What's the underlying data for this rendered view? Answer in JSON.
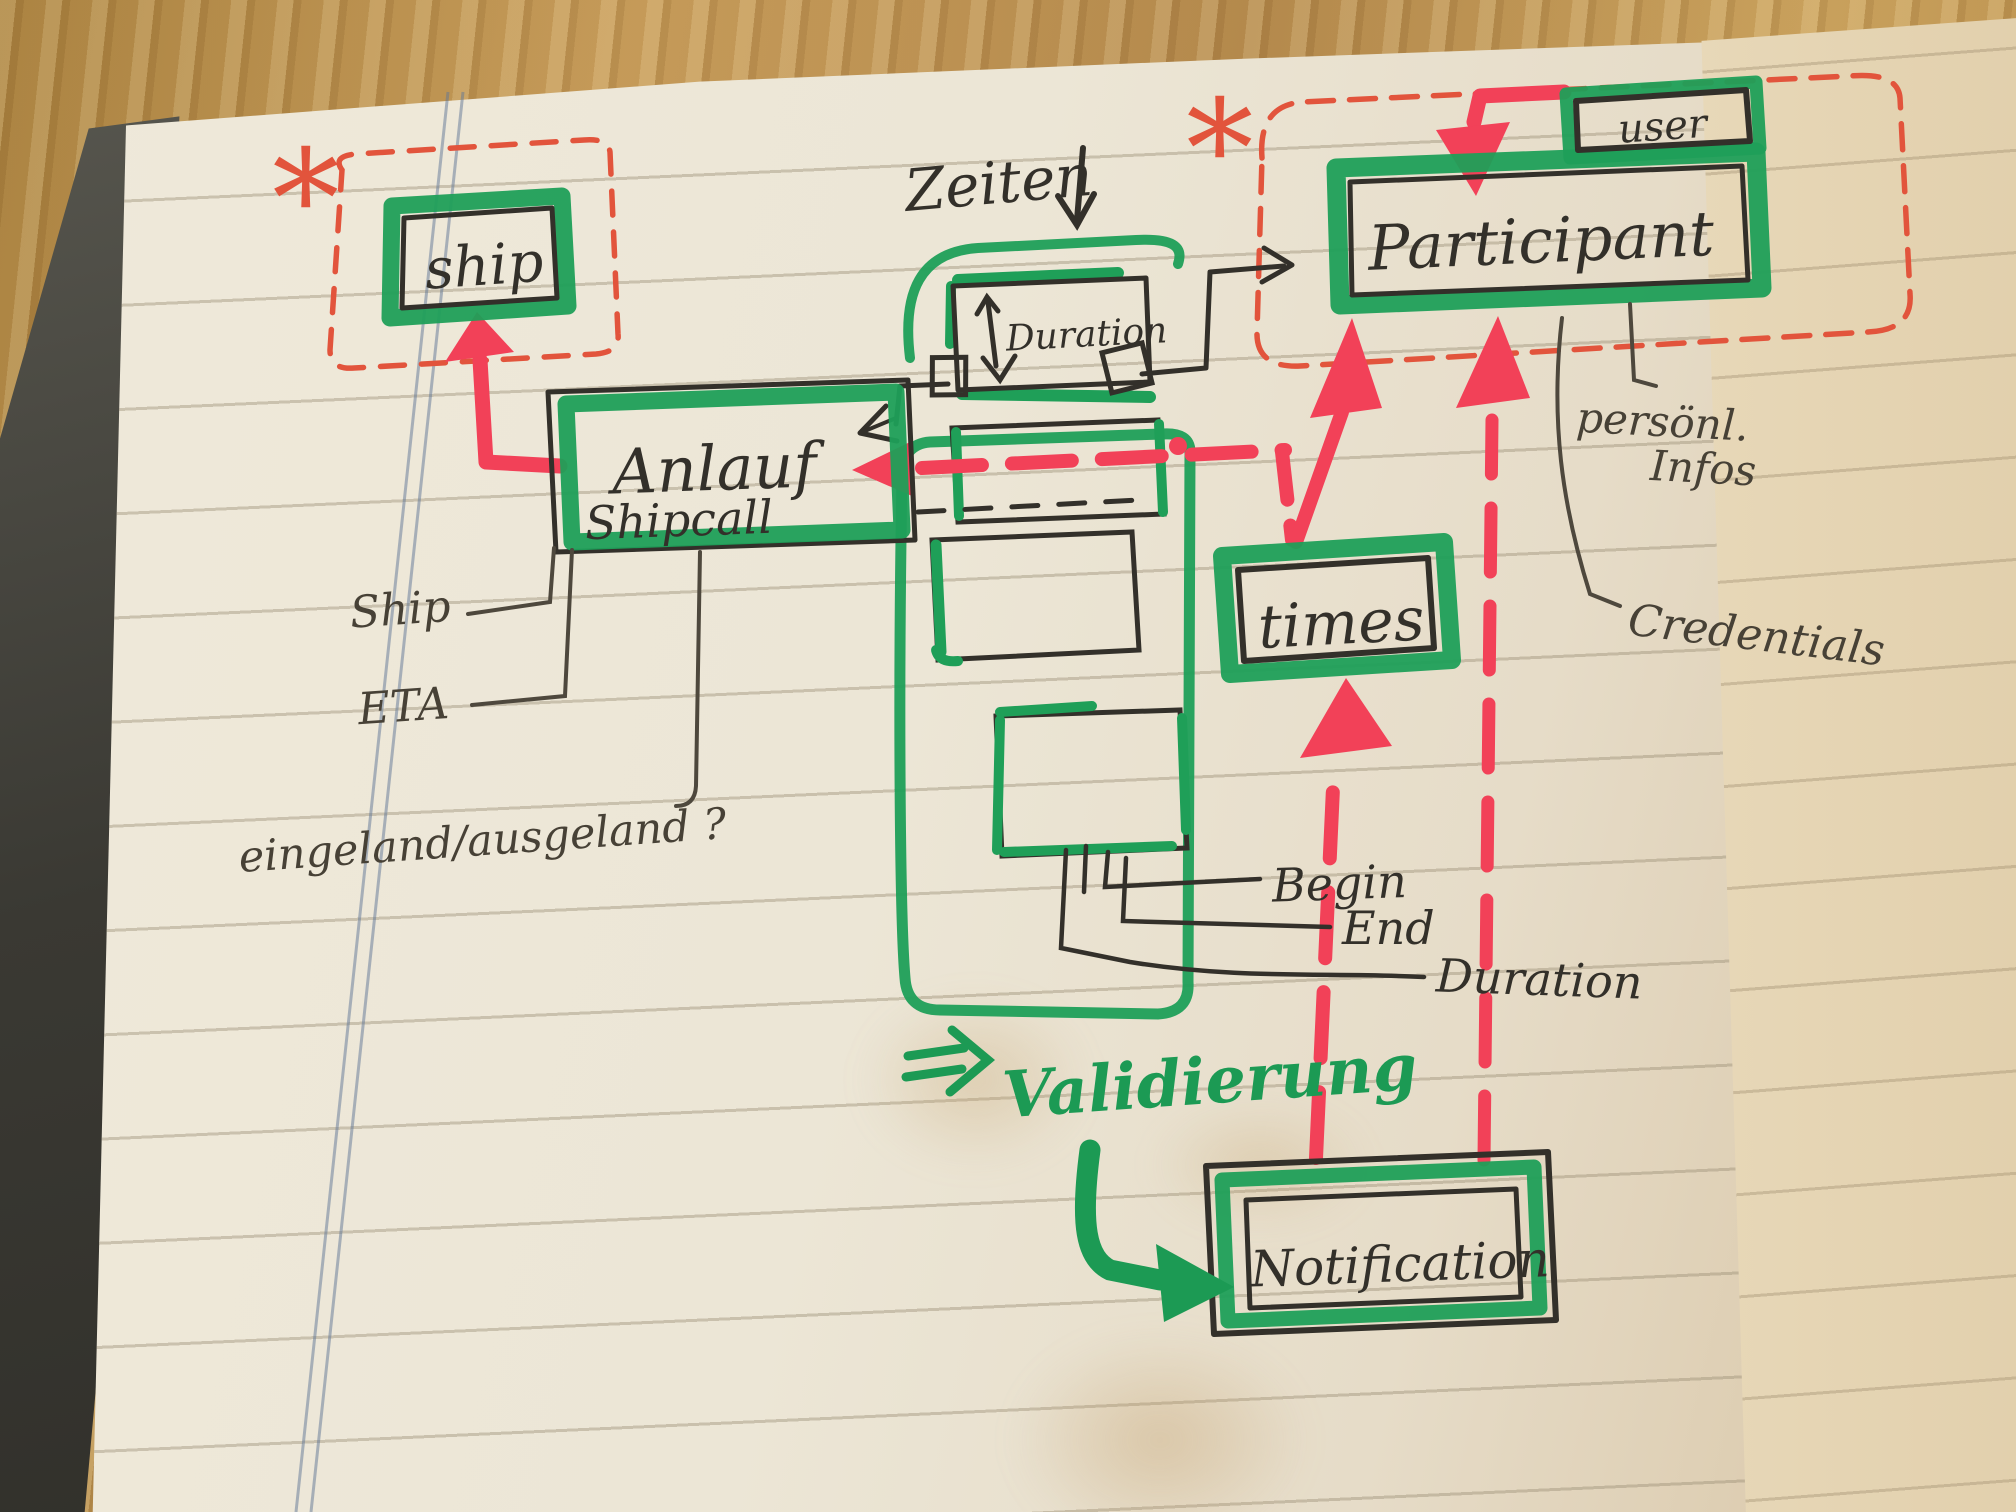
{
  "photo": {
    "surface": "wooden-table",
    "page": "lined-notebook-paper",
    "colors": {
      "marker_green": "#1f9f58",
      "marker_red": "#f24158",
      "pencil_red": "#e2543c",
      "ink_black": "#33302a",
      "pencil_gray": "#4e483d",
      "paper": "#ece6d6",
      "wood": "#b98f52"
    }
  },
  "diagram": {
    "marks": {
      "asterisk_left": "*",
      "asterisk_right": "*"
    },
    "boxes": {
      "ship": {
        "label": "ship"
      },
      "anlauf": {
        "line1": "Anlauf",
        "line2": "Shipcall"
      },
      "duration": {
        "label": "Duration"
      },
      "participant": {
        "label": "Participant"
      },
      "user": {
        "label": "user"
      },
      "times": {
        "label": "times"
      },
      "notification": {
        "label": "Notification"
      }
    },
    "annotations": {
      "zeiten": "Zeiten",
      "ship_attr": "Ship",
      "eta_attr": "ETA",
      "inout_attr": "eingeland/ausgeland ?",
      "personal_line1": "persönl.",
      "personal_line2": "Infos",
      "credentials": "Credentials",
      "begin": "Begin",
      "end": "End",
      "duration_attr": "Duration",
      "validierung": "Validierung"
    }
  }
}
